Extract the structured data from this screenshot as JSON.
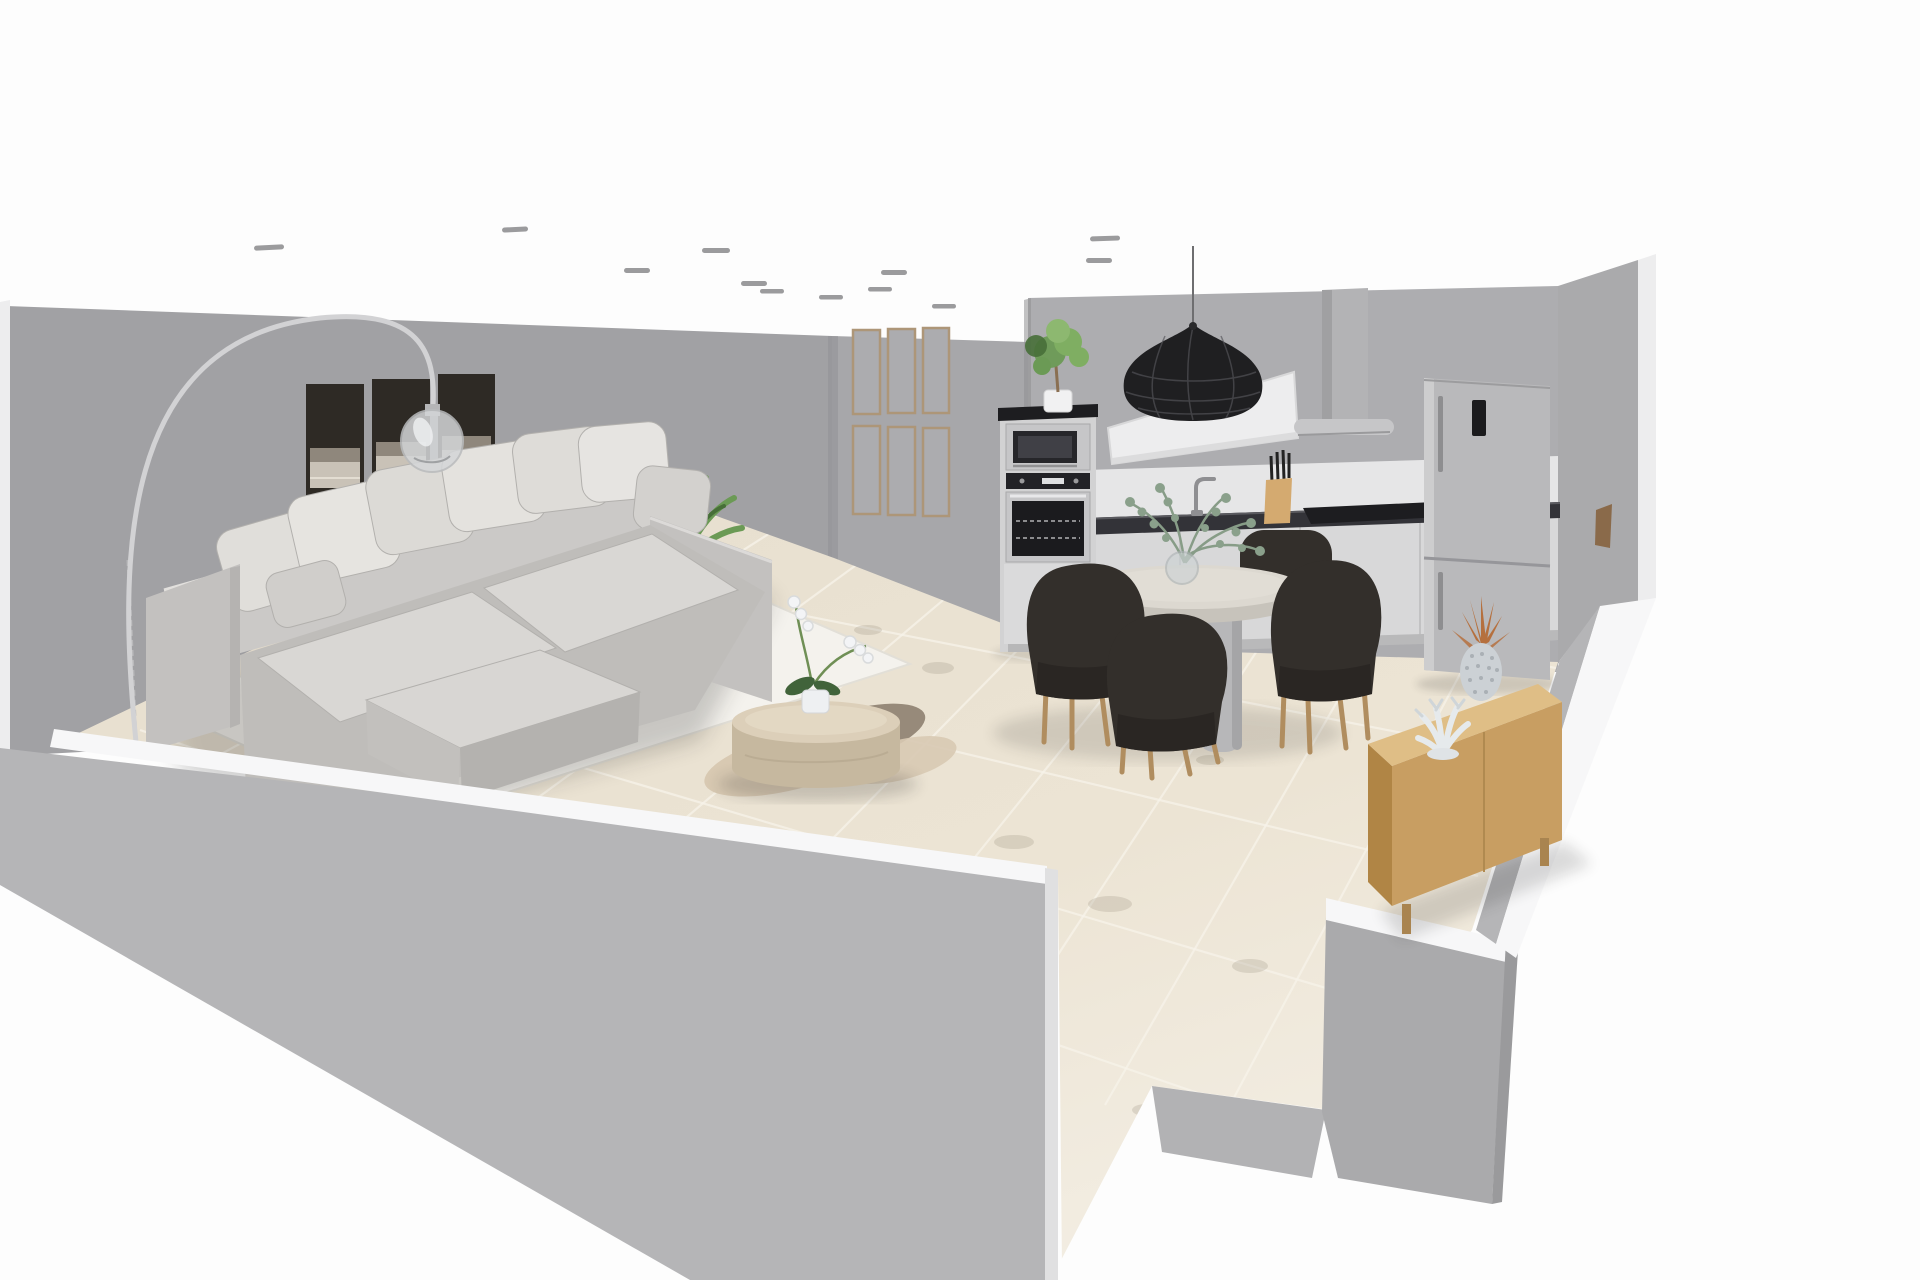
{
  "scene": {
    "type": "interior-3d-render",
    "description": "Cut-away 3D view of an open-plan apartment: living room with sectional sofa at left, kitchen with appliances along the back wall, round dining table with four chairs, and a wooden sideboard at right. Low front walls reveal the interior; no UI chrome or text is visible.",
    "rooms": [
      "living-room",
      "kitchen-dining"
    ],
    "objects": [
      {
        "name": "wall-art-triptych",
        "color": "#2e2a25"
      },
      {
        "name": "gallery-frame-grid",
        "count": 6,
        "color": "#ad9678"
      },
      {
        "name": "arc-floor-lamp",
        "color": "#d2d2d4"
      },
      {
        "name": "sectional-sofa",
        "color": "#cbc9c7"
      },
      {
        "name": "throw-pillows",
        "count": 8,
        "color": "#e4e2df"
      },
      {
        "name": "area-rug",
        "color": "#f4f2ed"
      },
      {
        "name": "fur-throw",
        "color": "#d8c9b2"
      },
      {
        "name": "round-coffee-table",
        "color": "#dccfb9"
      },
      {
        "name": "orchid-plant",
        "color": "#f3f4f6"
      },
      {
        "name": "palm-plant",
        "color": "#6b9a55"
      },
      {
        "name": "potted-tree",
        "color": "#7fae62"
      },
      {
        "name": "double-oven-tower",
        "color": "#c6c6c8"
      },
      {
        "name": "pendant-lamp",
        "color": "#1f1f21"
      },
      {
        "name": "wall-shelf",
        "color": "#ededee"
      },
      {
        "name": "extractor-hood",
        "color": "#b3b3b5"
      },
      {
        "name": "kitchen-counter",
        "color": "#333338"
      },
      {
        "name": "cooktop",
        "color": "#18181a"
      },
      {
        "name": "knife-block",
        "color": "#d4aa70"
      },
      {
        "name": "faucet",
        "color": "#8f8f92"
      },
      {
        "name": "fridge-freezer",
        "color": "#b9b9bb"
      },
      {
        "name": "round-dining-table",
        "color": "#dcd8d0"
      },
      {
        "name": "dining-chairs",
        "count": 4,
        "color": "#332f2b"
      },
      {
        "name": "eucalyptus-vase",
        "color": "#879c87"
      },
      {
        "name": "wooden-sideboard",
        "color": "#c89e62"
      },
      {
        "name": "pineapple-decor",
        "color": "#b5703e"
      },
      {
        "name": "coral-decor",
        "color": "#e9ecee"
      },
      {
        "name": "tiled-floor",
        "color": "#e9e1d2"
      },
      {
        "name": "ceiling-spotlights",
        "count": 12,
        "color": "#9b9b9d"
      }
    ]
  },
  "palette": {
    "bg": "#fdfdfd",
    "wall": "#a1a1a4",
    "wall_light": "#a7a7aa",
    "wall_kitchen": "#adadb0",
    "wall_east": "#aaaaac",
    "wall_front": "#b5b5b7",
    "wall_top": "#f7f7f8",
    "wall_outer": "#ededee",
    "corner_shade": "#8f8f92",
    "floor": "#e9e1d2",
    "floor_light": "#f4efe5",
    "grout": "#f7f3e9",
    "tile_smudge": "#8d8574",
    "rug": "#f4f2ed",
    "rug_edge": "#e2dfd7",
    "sofa": "#cbc9c7",
    "sofa_dark": "#c3c1bf",
    "sofa_base": "#bfbdba",
    "sofa_cushion": "#d9d7d4",
    "seam": "#b2b0ad",
    "pillow_light": "#e6e4e0",
    "pillow_mid": "#dcdad6",
    "art_dark": "#2e2a25",
    "art_mid": "#8f877c",
    "art_band": "#c9c2b7",
    "frame_wood": "#ad9678",
    "frame_pane": "#acacaf",
    "plant": "#6b9a55",
    "plant_dark": "#476f38",
    "lamp_metal": "#d2d2d4",
    "glass": "#d4d6d8",
    "pendant": "#1f1f21",
    "pendant_line": "#55555a",
    "chair": "#332f2b",
    "chair_seat": "#2a2623",
    "wood_leg": "#b08d5f",
    "table_top": "#dcd8d0",
    "table_rim": "#c7c3bb",
    "pedestal": "#b7b7b9",
    "counter_dark": "#333338",
    "cabinet": "#d8d8d9",
    "backsplash": "#e6e6e7",
    "appliance": "#c6c6c8",
    "appliance_dark": "#1d1d20",
    "fridge": "#b9b9bb",
    "hood": "#b3b3b5",
    "sideboard_top": "#dfbe86",
    "sideboard_front": "#c89e62",
    "sideboard_side": "#b08545",
    "knife_block": "#d4aa70",
    "copper": "#b5703e",
    "white_decor": "#e9ecee",
    "eucalyptus": "#879c87",
    "ceiling_dash": "#9b9b9d",
    "throw_dark": "#978a7a",
    "throw_light": "#d8c9b2",
    "door_wood": "#8a6a4a",
    "coffee_top": "#dccfb9",
    "coffee_side": "#c6b89f"
  }
}
